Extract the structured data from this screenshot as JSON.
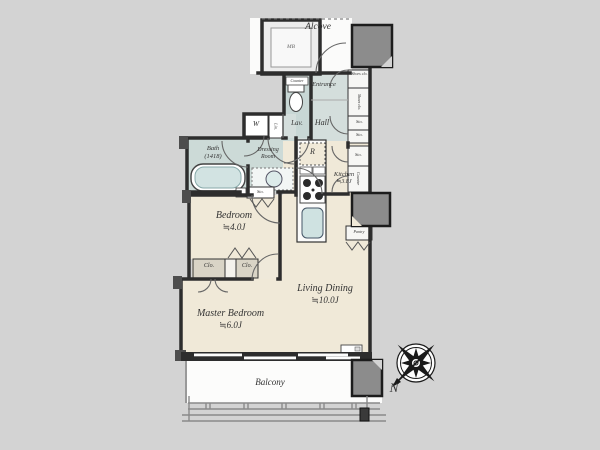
{
  "plan_title": "apartment-floor-plan",
  "labels": {
    "alcove": "Alcove",
    "mb": "MB",
    "entrance": "Entrance",
    "hall": "Hall",
    "lav": "Lav.",
    "lav_counter": "Counter",
    "shoes_clo_a": "Shoes clo.",
    "shoes_clo_b": "Shoes clo.",
    "sto_1": "Sto.",
    "sto_2": "Sto.",
    "sto_3": "Sto.",
    "counter": "Counter",
    "pantry": "Pantry",
    "washer": "W",
    "linen": "Lin.",
    "bath_name": "Bath",
    "bath_size": "(1418)",
    "dressing_line1": "Dressing",
    "dressing_line2": "Room",
    "dressing_sto": "Sto.",
    "fridge": "R",
    "kitchen_name": "Kitchen",
    "kitchen_area": "≒3.8J",
    "bedroom_name": "Bedroom",
    "bedroom_area": "≒4.0J",
    "closet_1": "Clo.",
    "closet_2": "Clo.",
    "master_name": "Master Bedroom",
    "master_area": "≒6.0J",
    "living_name": "Living Dining",
    "living_area": "≒10.0J",
    "balcony": "Balcony",
    "compass_north": "N"
  },
  "colors": {
    "background": "#d3d3d3",
    "room_cream": "#f0e9d8",
    "wet_area": "#ccdad7",
    "corridor": "#d4dedc",
    "wall": "#2d2d2d",
    "pillar": "#8c8c8c",
    "closet_fill": "#d9d4c6",
    "fixture_blue": "#cfe2e1"
  }
}
